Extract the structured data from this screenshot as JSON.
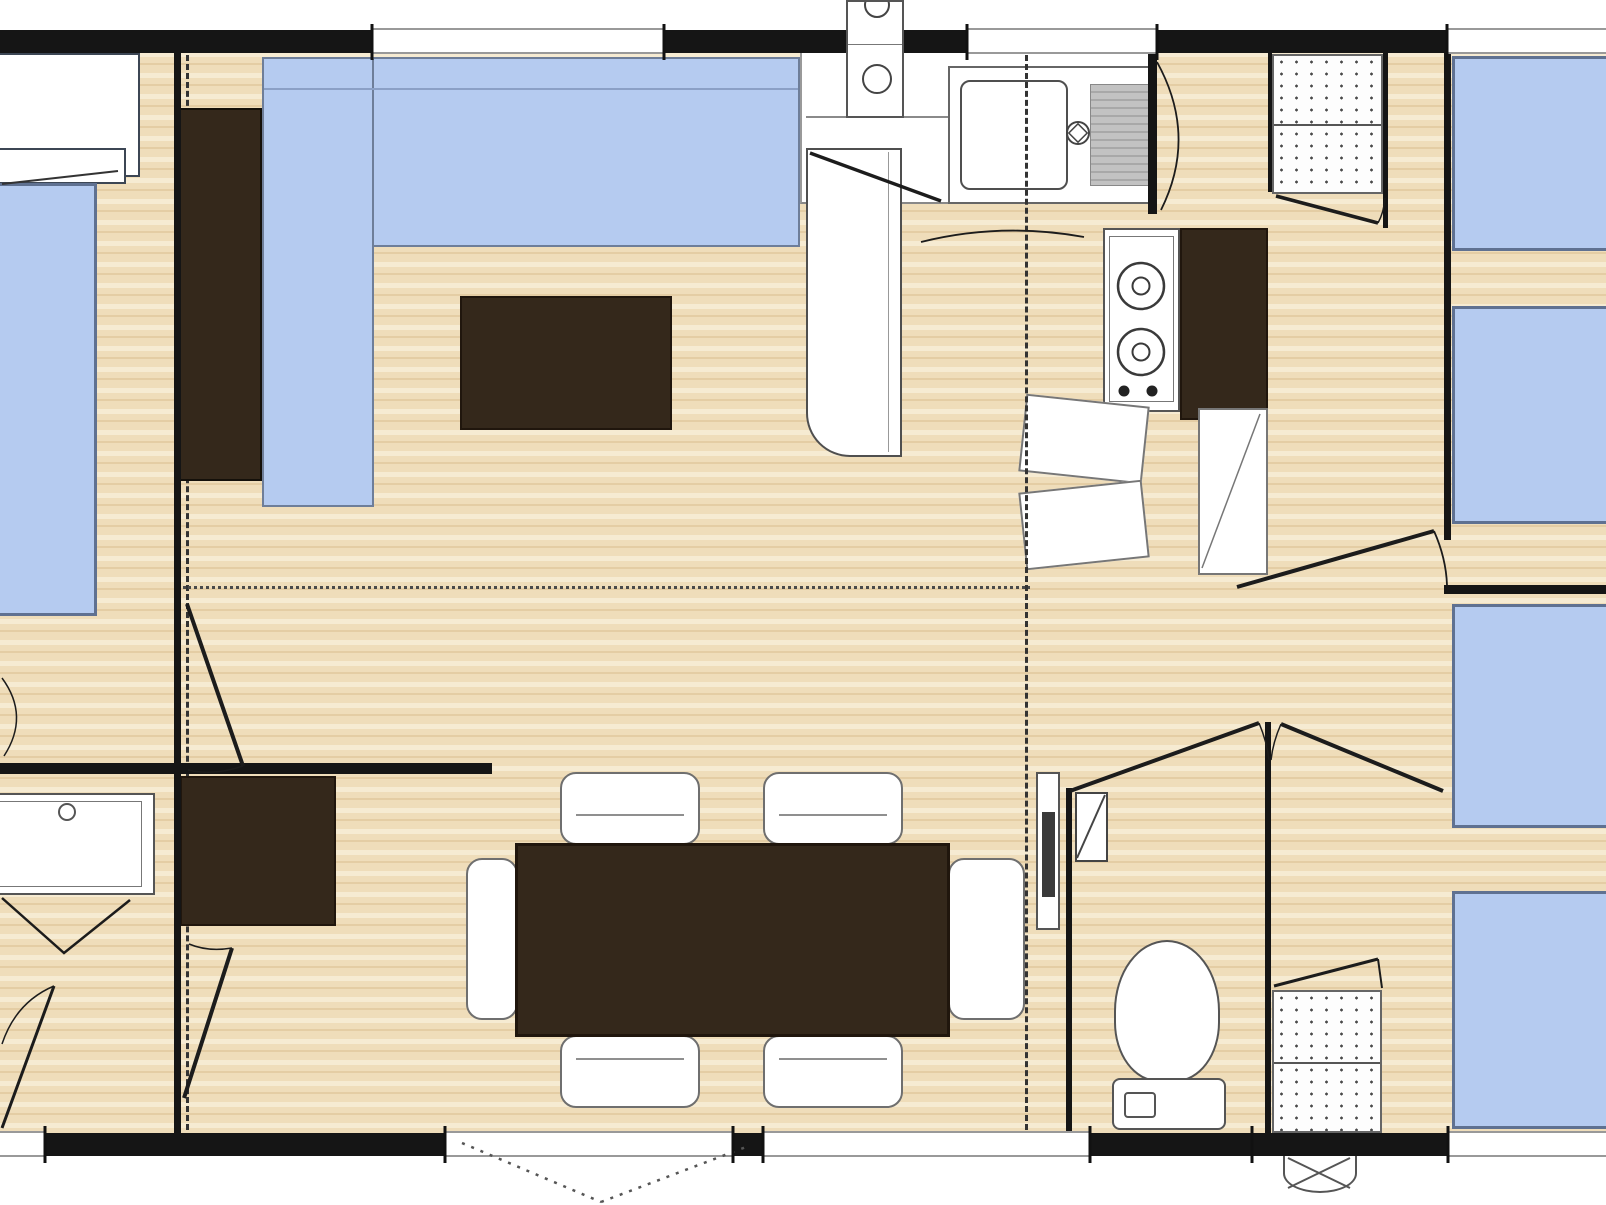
{
  "title": "mobile-home floor plan",
  "colors": {
    "background": "#ffffff",
    "wall": "#151515",
    "floor_base": "#efddba",
    "floor_stripe_light": "#f6ebd2",
    "floor_stripe_dark": "#e4cda4",
    "bed_fill": "#b5cbf0",
    "bed_border": "#5f7191",
    "sofa_fill": "#b5cbf0",
    "furniture_dark": "#34281b",
    "furniture_dark_border": "#20160d",
    "fixture_white": "#ffffff",
    "fixture_border": "#4f4f4f",
    "window_line": "#999999",
    "drainer_gray": "#c2c2c2",
    "line_dark": "#1c1c1c"
  },
  "fixtures": [
    "double-bed",
    "pillow",
    "wardrobe",
    "l-shaped-sofa",
    "coffee-table",
    "kitchen-sink",
    "drainer",
    "faucet",
    "boiler-column",
    "fridge",
    "gas-hob-2-burners",
    "kitchen-cabinet",
    "base-cabinets",
    "hanging-wardrobe-top-right",
    "single-bed-1",
    "single-bed-2",
    "single-bed-3",
    "single-bed-4",
    "dining-table",
    "dining-chairs-x6",
    "bathroom-vanity",
    "bathroom-cabinet",
    "radiator",
    "corner-shelf",
    "toilet-wc",
    "hanging-wardrobe-toilet",
    "exterior-vent",
    "entry-door-swing"
  ],
  "counts": {
    "beds": 5,
    "dining_chairs": 6,
    "doors_swing": 9,
    "windows_top": 3,
    "windows_bottom": 4
  }
}
